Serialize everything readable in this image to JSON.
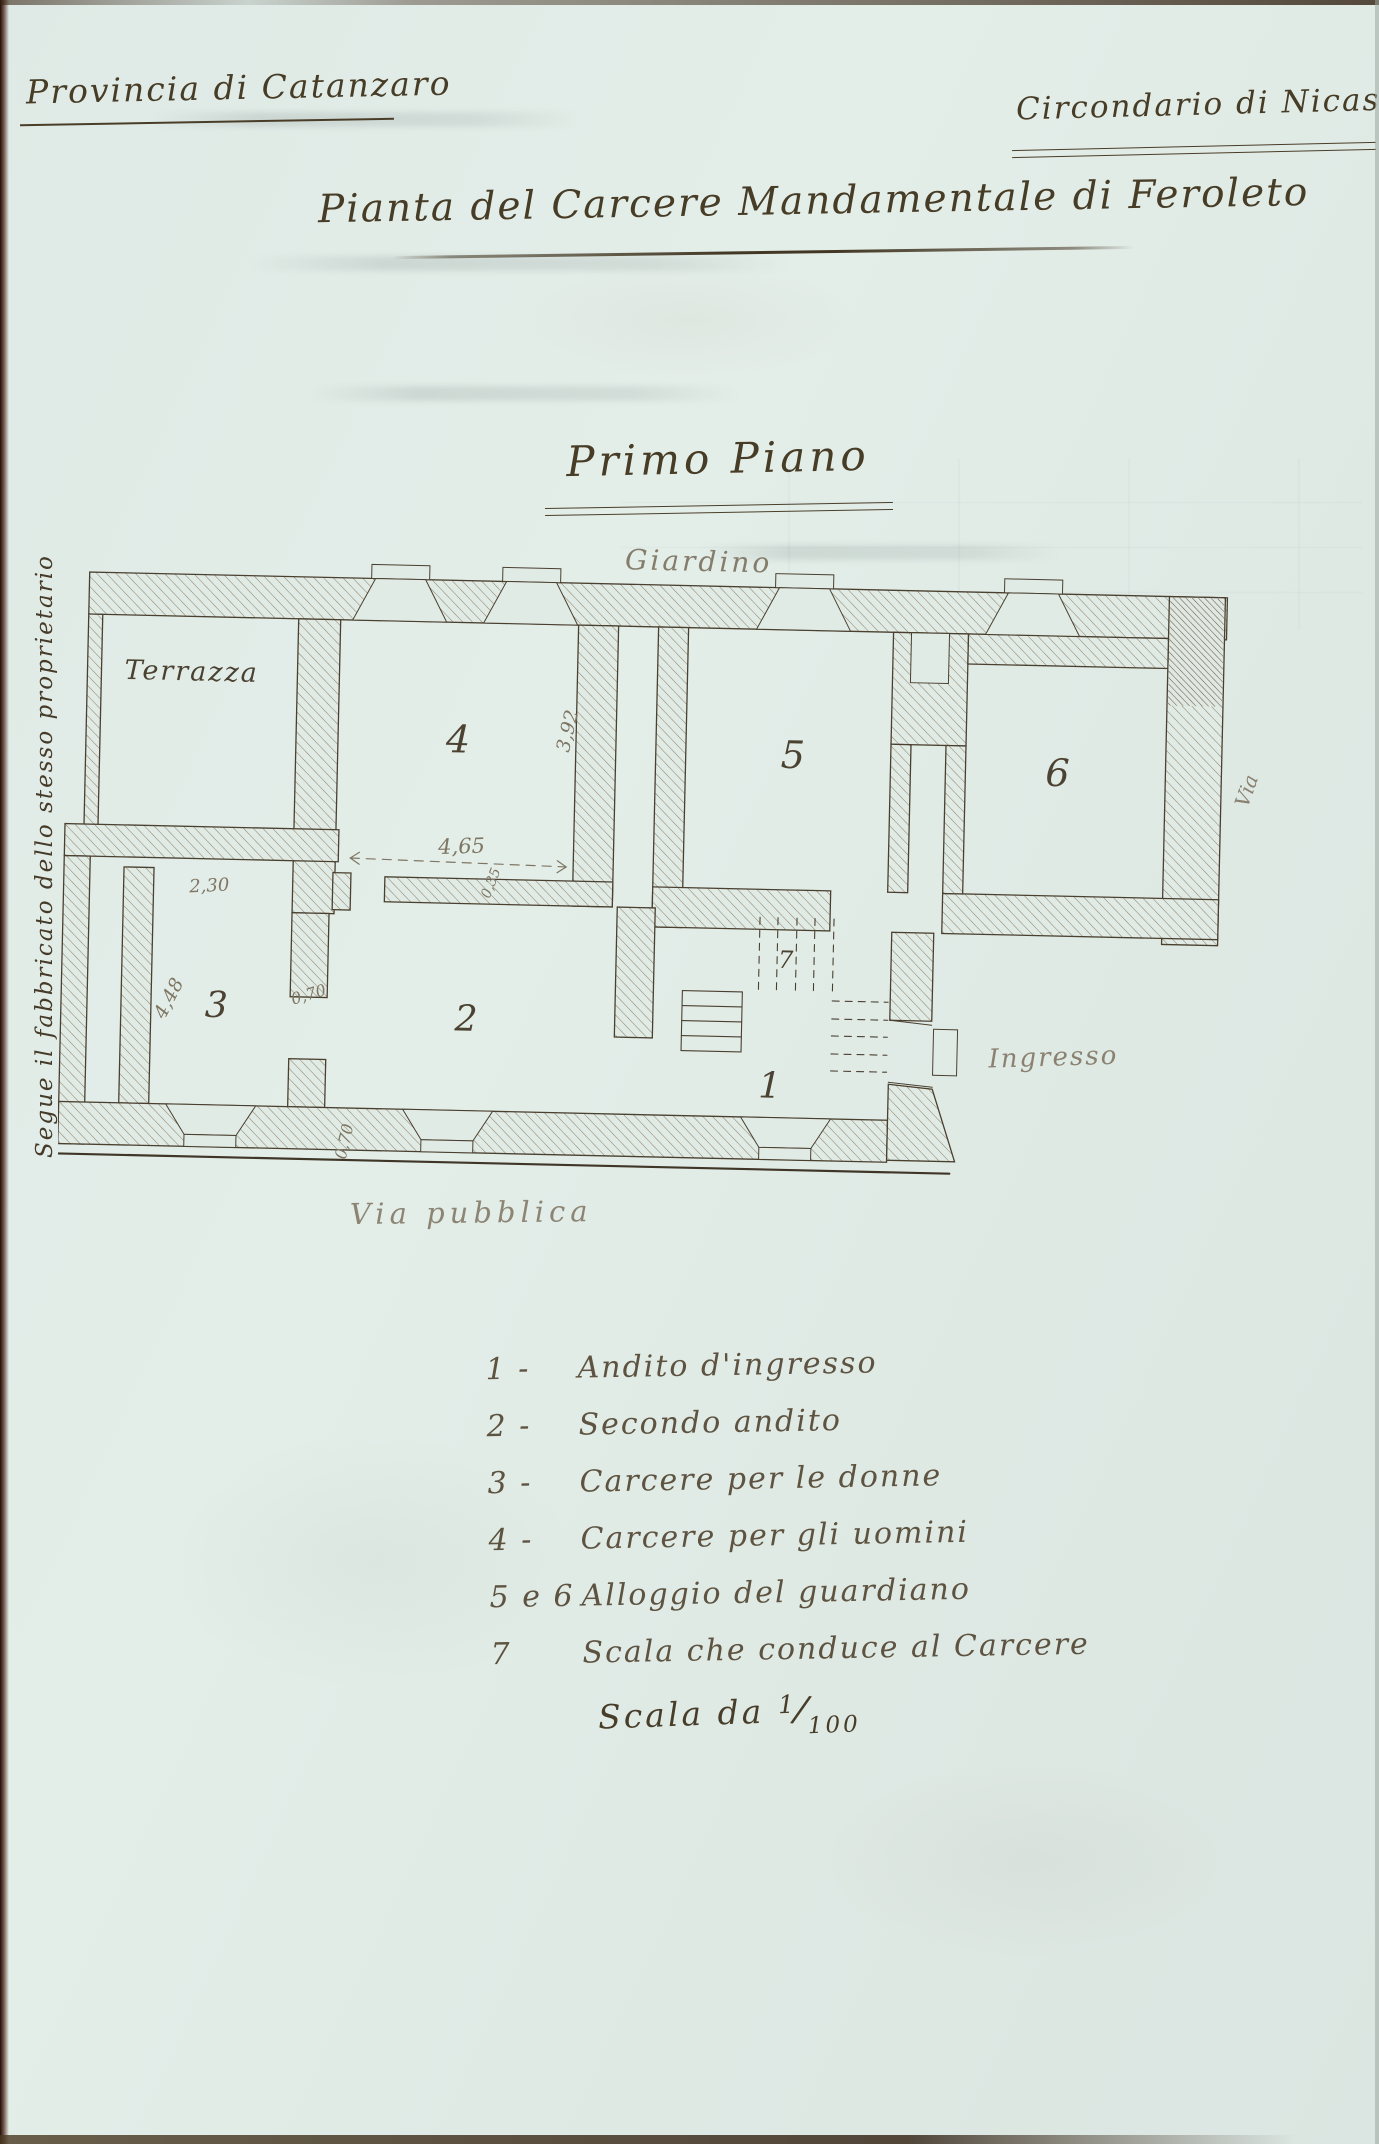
{
  "header": {
    "province": "Provincia di Catanzaro",
    "district": "Circondario di Nicastro"
  },
  "title": "Pianta del Carcere Mandamentale di Feroleto",
  "subtitle": "Primo Piano",
  "plan": {
    "garden_label": "Giardino",
    "terrace_label": "Terrazza",
    "entrance_label": "Ingresso",
    "public_street_label": "Via pubblica",
    "side_street_label": "Via",
    "adjacent_building_note": "Segue il fabbricato dello stesso proprietario",
    "rooms": {
      "r1": "1",
      "r2": "2",
      "r3": "3",
      "r4": "4",
      "r5": "5",
      "r6": "6",
      "r7": "7"
    },
    "dimensions": {
      "room4_depth": "3,92",
      "room4_width": "4,65",
      "wall_thickness": "0,35",
      "room3_width": "2,30",
      "door_width": "0,70",
      "room3_depth": "4,48",
      "window_width": "0,70"
    }
  },
  "legend": {
    "items": [
      {
        "n": "1 -",
        "t": "Andito d'ingresso"
      },
      {
        "n": "2 -",
        "t": "Secondo andito"
      },
      {
        "n": "3 -",
        "t": "Carcere per le donne"
      },
      {
        "n": "4 -",
        "t": "Carcere per gli uomini"
      },
      {
        "n": "5 e 6",
        "t": "Alloggio del guardiano"
      },
      {
        "n": "7",
        "t": "Scala che conduce al Carcere"
      }
    ]
  },
  "scale": {
    "prefix": "Scala da",
    "numerator": "1",
    "denominator": "100"
  }
}
